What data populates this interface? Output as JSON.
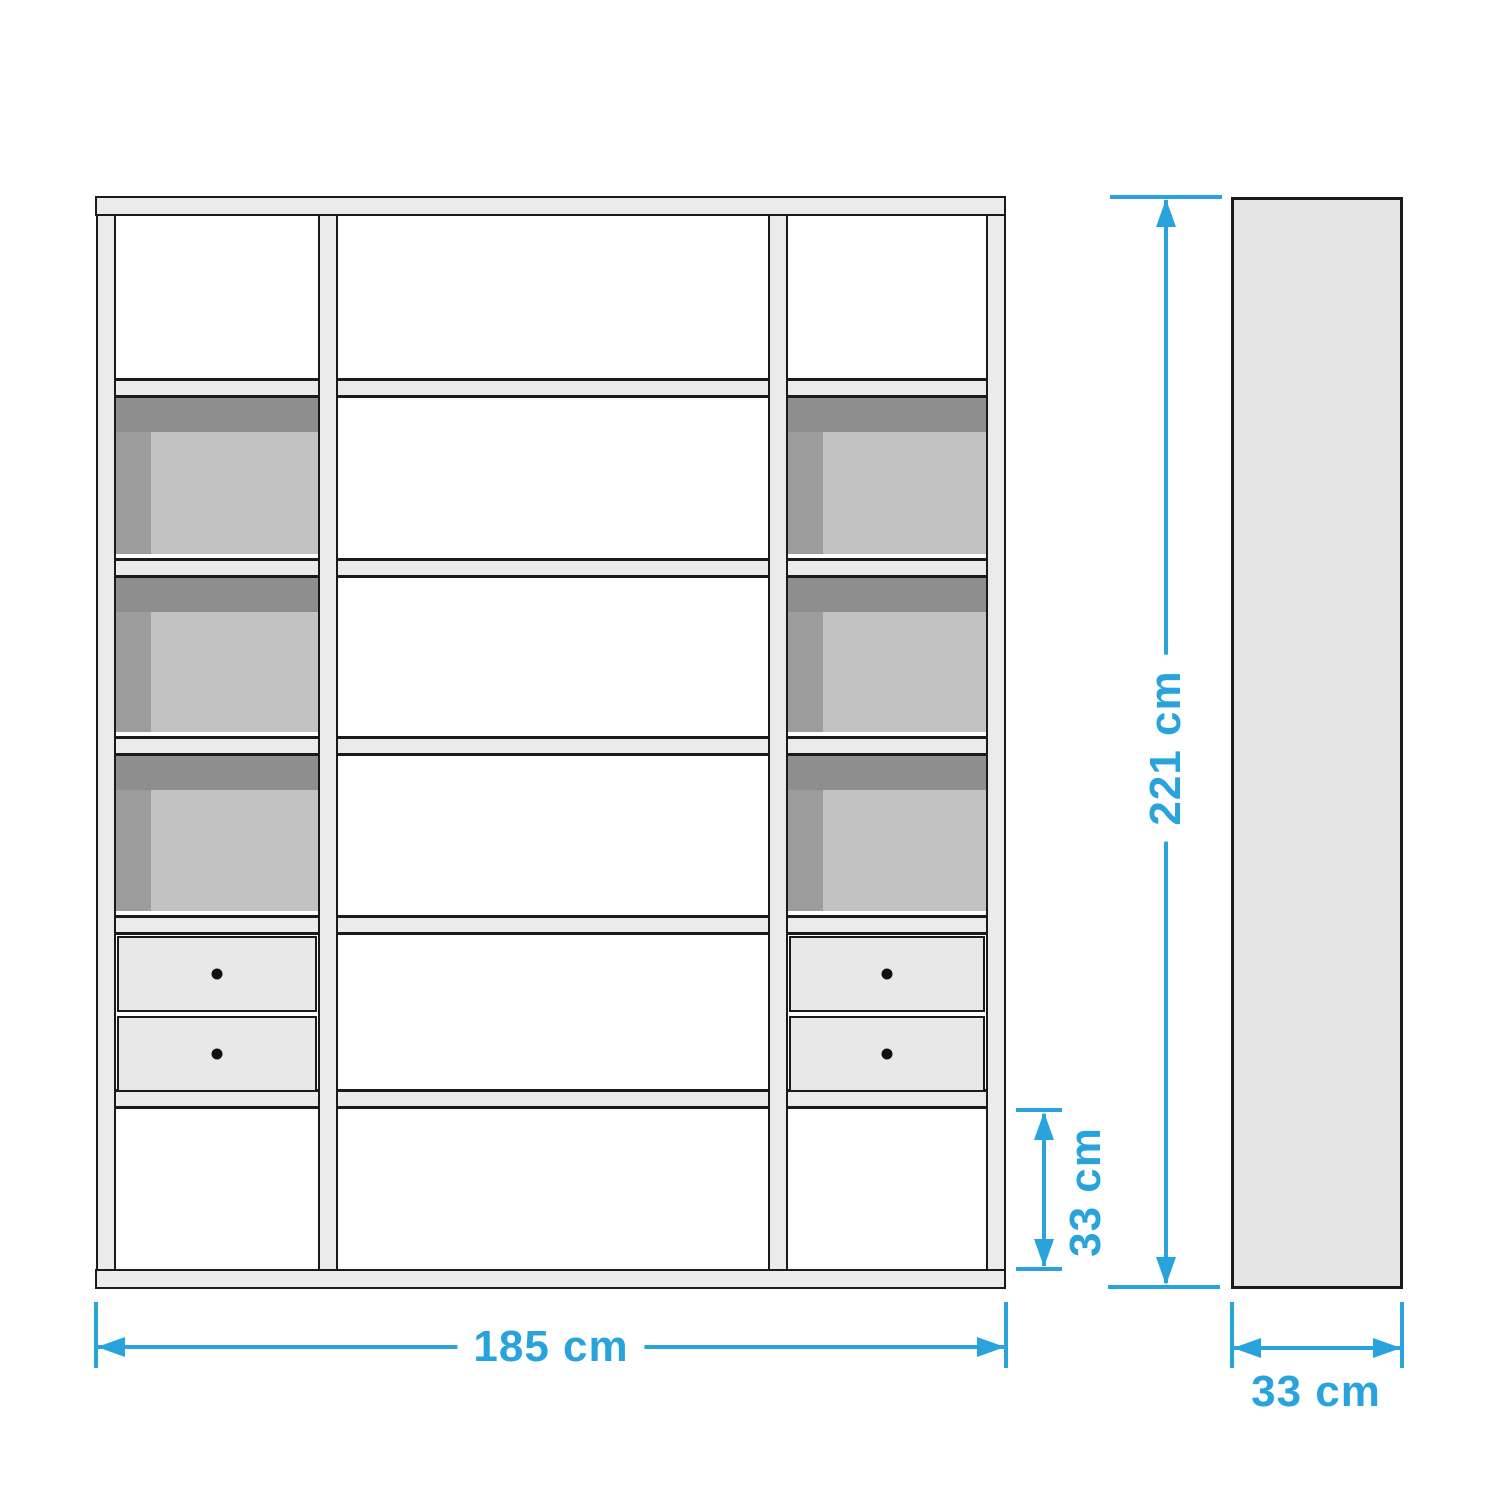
{
  "dimensions": {
    "height": "221 cm",
    "width": "185 cm",
    "depth": "33 cm",
    "compartment_height": "33 cm"
  },
  "structure": {
    "columns": 3,
    "shelf_levels_per_column": 5,
    "storage_boxes": 6,
    "drawers": 4,
    "drawer_knob_icon": "black-dot"
  },
  "colors": {
    "accent": "#29a3dc",
    "structure_fill": "#ebebeb",
    "structure_border": "#1a1a1a",
    "box_top": "#8e8e8e",
    "box_side": "#9c9c9c",
    "box_front": "#c2c2c2",
    "drawer_fill": "#e8e8e8",
    "side_panel_fill": "#e4e4e4",
    "knob": "#111111",
    "background": "#ffffff"
  }
}
